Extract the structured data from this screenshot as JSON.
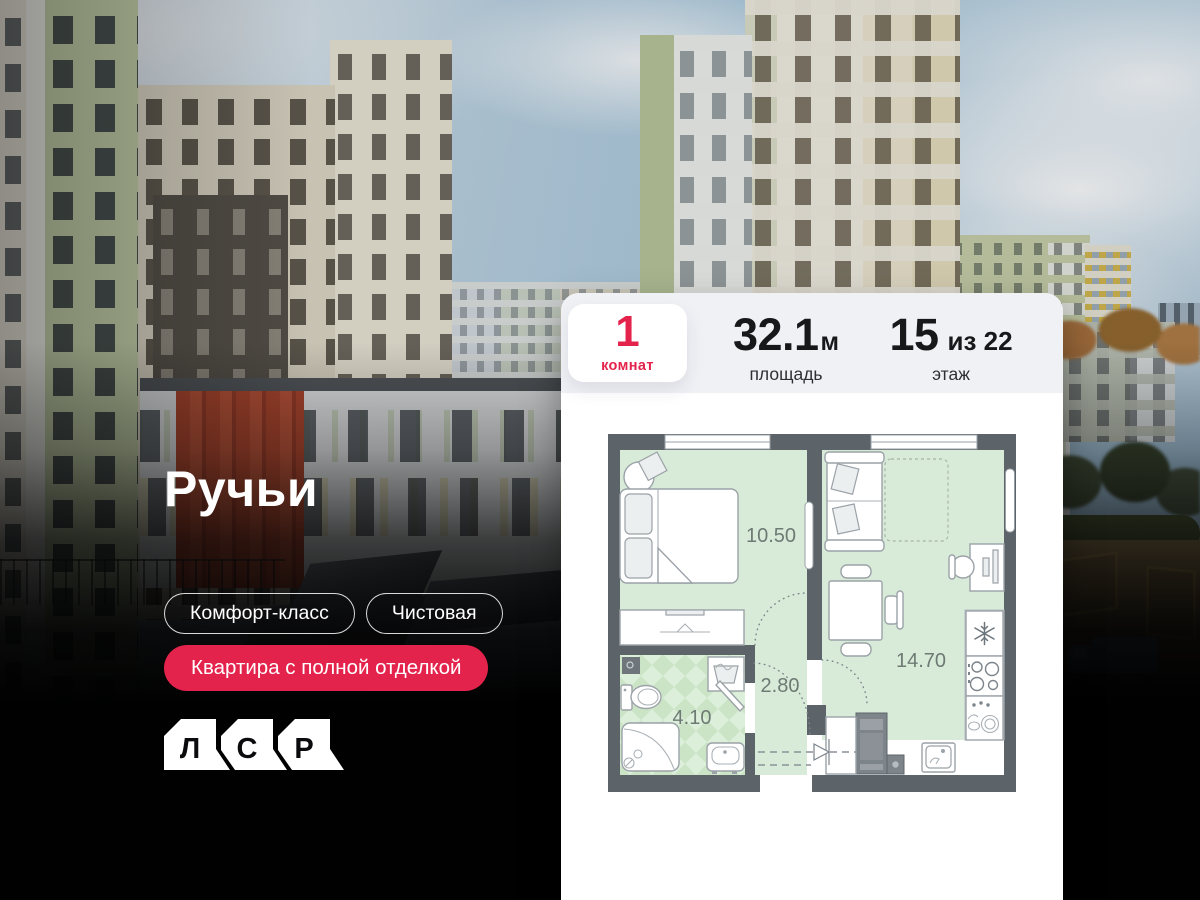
{
  "project": {
    "title": "Ручьи"
  },
  "badges": {
    "outline": [
      {
        "label": "Комфорт-класс"
      },
      {
        "label": "Чистовая"
      }
    ],
    "solid": {
      "label": "Квартира с полной отделкой"
    }
  },
  "logo": {
    "letters": [
      "Л",
      "С",
      "Р"
    ]
  },
  "stats": {
    "rooms": {
      "value": "1",
      "label": "комнат"
    },
    "area": {
      "value": "32.1",
      "unit": "м",
      "label": "площадь"
    },
    "floor": {
      "value": "15",
      "of": "из 22",
      "label": "этаж"
    }
  },
  "floorplan": {
    "room_areas": {
      "bedroom": "10.50",
      "kitchen_living": "14.70",
      "hallway": "2.80",
      "bathroom": "4.10"
    }
  },
  "colors": {
    "accent": "#e4234c",
    "plan_wall": "#5d6469",
    "plan_floor": "#d7ebd8",
    "panel_strip": "#f0f1f5"
  }
}
